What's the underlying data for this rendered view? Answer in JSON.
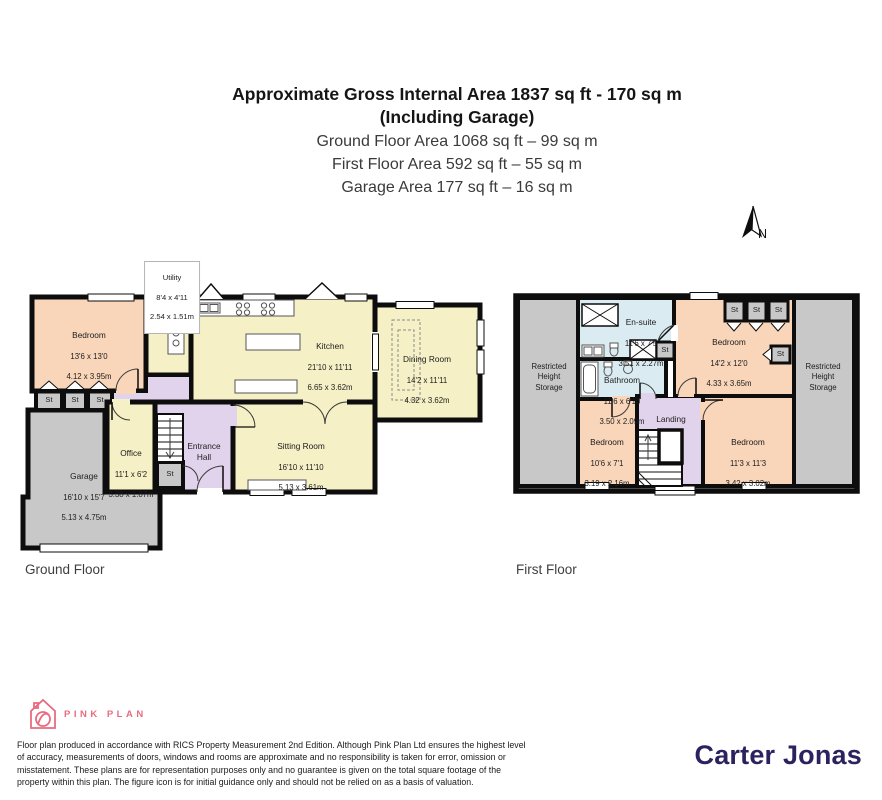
{
  "header": {
    "title_bold_1": "Approximate Gross Internal Area 1837 sq ft - 170 sq m",
    "title_bold_2": "(Including Garage)",
    "sub_1": "Ground Floor Area 1068 sq ft – 99 sq m",
    "sub_2": "First Floor Area 592 sq ft – 55 sq m",
    "sub_3": "Garage Area 177 sq ft – 16 sq m"
  },
  "compass": {
    "north_label": "N"
  },
  "ground_floor": {
    "floor_label": "Ground Floor",
    "utility": {
      "name": "Utility",
      "imperial": "8'4 x 4'11",
      "metric": "2.54 x 1.51m"
    },
    "bedroom": {
      "name": "Bedroom",
      "imperial": "13'6 x 13'0",
      "metric": "4.12 x 3.95m"
    },
    "kitchen": {
      "name": "Kitchen",
      "imperial": "21'10 x 11'11",
      "metric": "6.65 x 3.62m"
    },
    "dining_room": {
      "name": "Dining Room",
      "imperial": "14'2 x 11'11",
      "metric": "4.32 x 3.62m"
    },
    "sitting_room": {
      "name": "Sitting Room",
      "imperial": "16'10 x 11'10",
      "metric": "5.13 x 3.61m"
    },
    "office": {
      "name": "Office",
      "imperial": "11'1 x 6'2",
      "metric": "3.38 x 1.87m"
    },
    "entrance_hall": {
      "name": "Entrance\nHall"
    },
    "garage": {
      "name": "Garage",
      "imperial": "16'10 x 15'7",
      "metric": "5.13 x 4.75m"
    },
    "st_label": "St"
  },
  "first_floor": {
    "floor_label": "First Floor",
    "restricted_storage": "Restricted\nHeight\nStorage",
    "en_suite": {
      "name": "En-suite",
      "imperial": "11'6 x 7'5",
      "metric": "3.51 x 2.27m"
    },
    "bathroom": {
      "name": "Bathroom",
      "imperial": "11'6 x 6'10",
      "metric": "3.50 x 2.09m"
    },
    "bedroom_1": {
      "name": "Bedroom",
      "imperial": "14'2 x 12'0",
      "metric": "4.33 x 3.65m"
    },
    "bedroom_2": {
      "name": "Bedroom",
      "imperial": "10'6 x 7'1",
      "metric": "3.19 x 2.16m"
    },
    "bedroom_3": {
      "name": "Bedroom",
      "imperial": "11'3 x 11'3",
      "metric": "3.42 x 3.02m"
    },
    "landing": {
      "name": "Landing"
    },
    "st_label": "St"
  },
  "footer": {
    "brand": "PINK PLAN",
    "disclaimer": "Floor plan produced in accordance with RICS Property Measurement 2nd Edition. Although Pink Plan Ltd ensures the highest level of accuracy, measurements of doors, windows and rooms are approximate and no responsibility is taken for error, omission or misstatement. These plans are for representation purposes only and no guarantee is given on the total square footage of the property within this plan. The figure icon is for initial guidance only and should not be relied on as a basis of valuation.",
    "agency": "Carter Jonas"
  },
  "colors": {
    "room_cream": "#f5f0c5",
    "room_peach": "#f9d6ba",
    "room_lavender": "#e2d3ec",
    "room_gray": "#c8c8c8",
    "room_blue": "#daecf2",
    "wall": "#0d0d0d",
    "brand_pink": "#e86b80",
    "agency_purple": "#2c2260"
  }
}
